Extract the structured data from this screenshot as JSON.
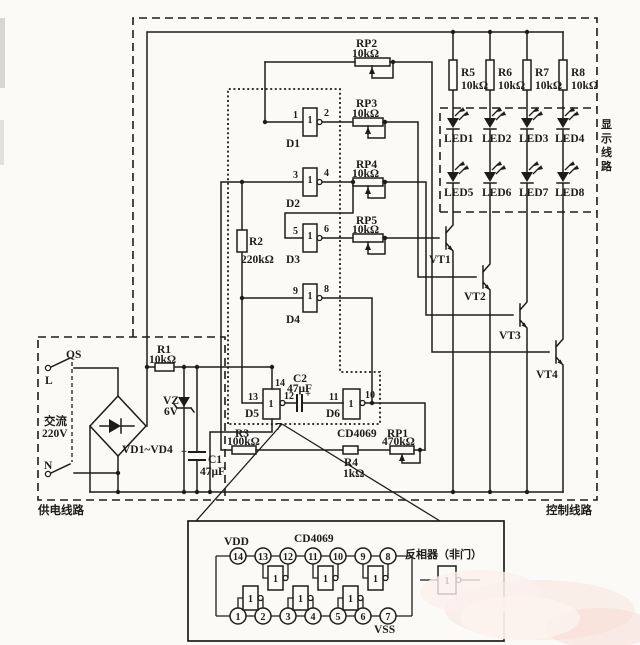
{
  "regions": {
    "supply": "供电线路",
    "control": "控制线路",
    "display_chars": [
      "显",
      "示",
      "线",
      "路"
    ]
  },
  "power": {
    "qs": "QS",
    "l": "L",
    "n": "N",
    "ac_line1": "交流",
    "ac_line2": "220V",
    "bridge": "VD1~VD4",
    "r1": {
      "name": "R1",
      "value": "10kΩ"
    },
    "vz": {
      "name": "VZ",
      "value": "6V"
    },
    "c1": {
      "name": "C1",
      "value": "47μF",
      "plus": "+"
    }
  },
  "gates_main": [
    {
      "name": "D1",
      "sym": "1",
      "pin_in": "1",
      "pin_out": "2"
    },
    {
      "name": "D2",
      "sym": "1",
      "pin_in": "3",
      "pin_out": "4"
    },
    {
      "name": "D3",
      "sym": "1",
      "pin_in": "5",
      "pin_out": "6"
    },
    {
      "name": "D4",
      "sym": "1",
      "pin_in": "9",
      "pin_out": "8"
    }
  ],
  "r2": {
    "name": "R2",
    "value": "220kΩ"
  },
  "pots": [
    {
      "name": "RP2",
      "value": "10kΩ"
    },
    {
      "name": "RP3",
      "value": "10kΩ"
    },
    {
      "name": "RP4",
      "value": "10kΩ"
    },
    {
      "name": "RP5",
      "value": "10kΩ"
    }
  ],
  "collector_resistors": [
    {
      "name": "R5",
      "value": "10kΩ"
    },
    {
      "name": "R6",
      "value": "10kΩ"
    },
    {
      "name": "R7",
      "value": "10kΩ"
    },
    {
      "name": "R8",
      "value": "10kΩ"
    }
  ],
  "leds": [
    "LED1",
    "LED2",
    "LED3",
    "LED4",
    "LED5",
    "LED6",
    "LED7",
    "LED8"
  ],
  "transistors": [
    "VT1",
    "VT2",
    "VT3",
    "VT4"
  ],
  "osc": {
    "d5": {
      "name": "D5",
      "sym": "1",
      "pin_in": "13",
      "pin_out": "12",
      "pin_vdd": "14",
      "pin_vss": "7"
    },
    "d6": {
      "name": "D6",
      "sym": "1",
      "pin_in": "11",
      "pin_out": "10"
    },
    "c2": {
      "name": "C2",
      "value": "47μF",
      "plus": "+"
    },
    "ic_label": "CD4069",
    "r3": {
      "name": "R3",
      "value": "100kΩ"
    },
    "r4": {
      "name": "R4",
      "value": "1kΩ"
    },
    "rp1": {
      "name": "RP1",
      "value": "470kΩ"
    }
  },
  "pinout": {
    "title": "CD4069",
    "vdd": "VDD",
    "vss": "VSS",
    "top_pins": [
      "14",
      "13",
      "12",
      "11",
      "10",
      "9",
      "8"
    ],
    "bottom_pins": [
      "1",
      "2",
      "3",
      "4",
      "5",
      "6",
      "7"
    ],
    "inverter_sym": "1",
    "legend": {
      "label": "反相器（非门）",
      "sym": "1"
    }
  }
}
